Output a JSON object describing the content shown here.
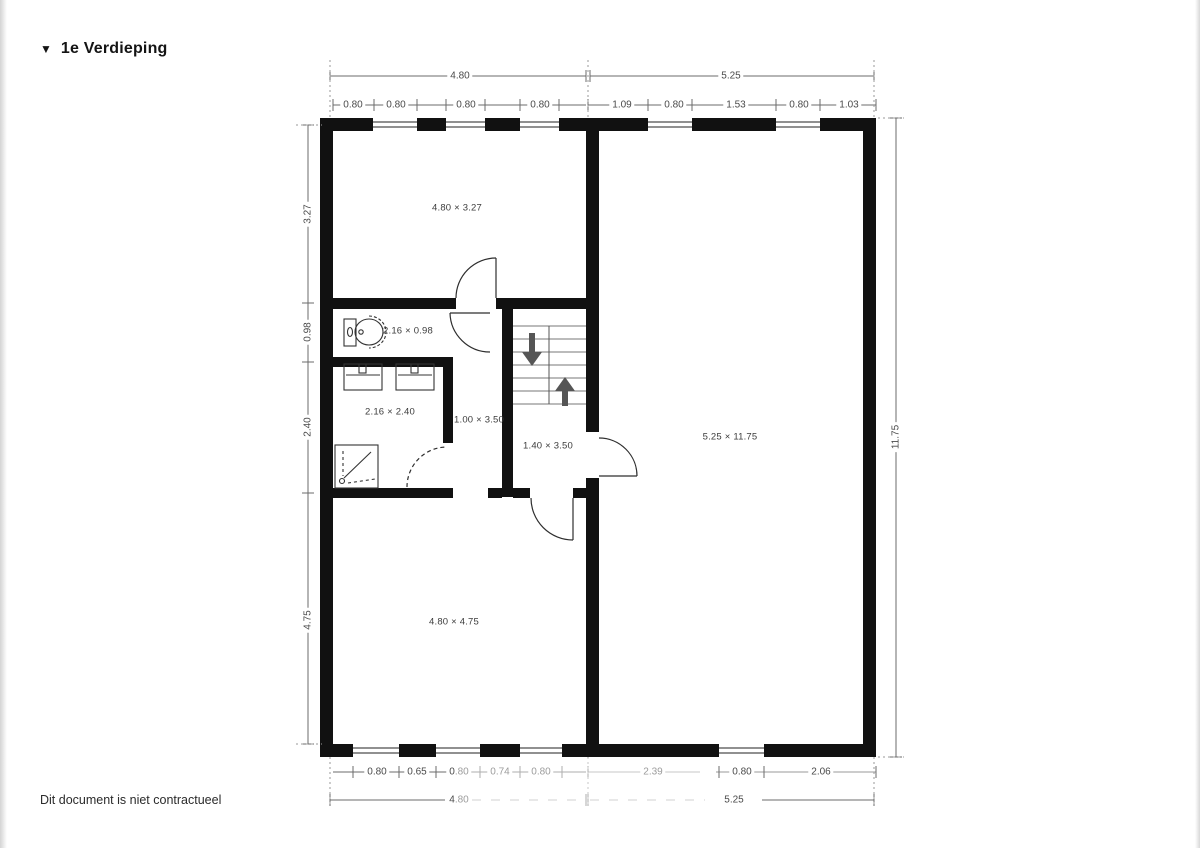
{
  "header": {
    "marker": "▼",
    "title": "1e Verdieping"
  },
  "footer": {
    "note": "Dit document is niet contractueel"
  },
  "rooms": {
    "top_left": "4.80 × 3.27",
    "toilet": "2.16 × 0.98",
    "bathroom": "2.16 × 2.40",
    "hallway": "1.00 × 3.50",
    "stair_hall": "1.40 × 3.50",
    "right": "5.25 × 11.75",
    "bottom_left": "4.80 × 4.75"
  },
  "dimensions": {
    "top_row": {
      "left_total": "4.80",
      "right_total": "5.25"
    },
    "top_segments": {
      "s1": "0.80",
      "s2": "0.80",
      "s3": "0.80",
      "s4": "0.80",
      "s5": "1.09",
      "s6": "0.80",
      "s7": "1.53",
      "s8": "0.80",
      "s9": "1.03"
    },
    "bottom_segments": {
      "s1": "0.80",
      "s2": "0.65",
      "s3": "0.80",
      "s4": "0.74",
      "s5": "0.80",
      "s6": "2.39",
      "s7": "0.80",
      "s8": "2.06"
    },
    "bottom_row": {
      "left_total": "4.80",
      "right_total": "5.25"
    },
    "left_side": {
      "s1": "3.27",
      "s2": "0.98",
      "s3": "2.40",
      "s4": "4.75"
    },
    "right_side": {
      "total": "11.75"
    }
  },
  "icons": {
    "stairs_down_arrow": "down-arrow",
    "stairs_up_arrow": "up-arrow",
    "section_marker": "triangle-down"
  },
  "colors": {
    "wall": "#111111",
    "dim_line": "#6b6b6b",
    "label": "#3c3c3c",
    "arrow": "#555555"
  }
}
